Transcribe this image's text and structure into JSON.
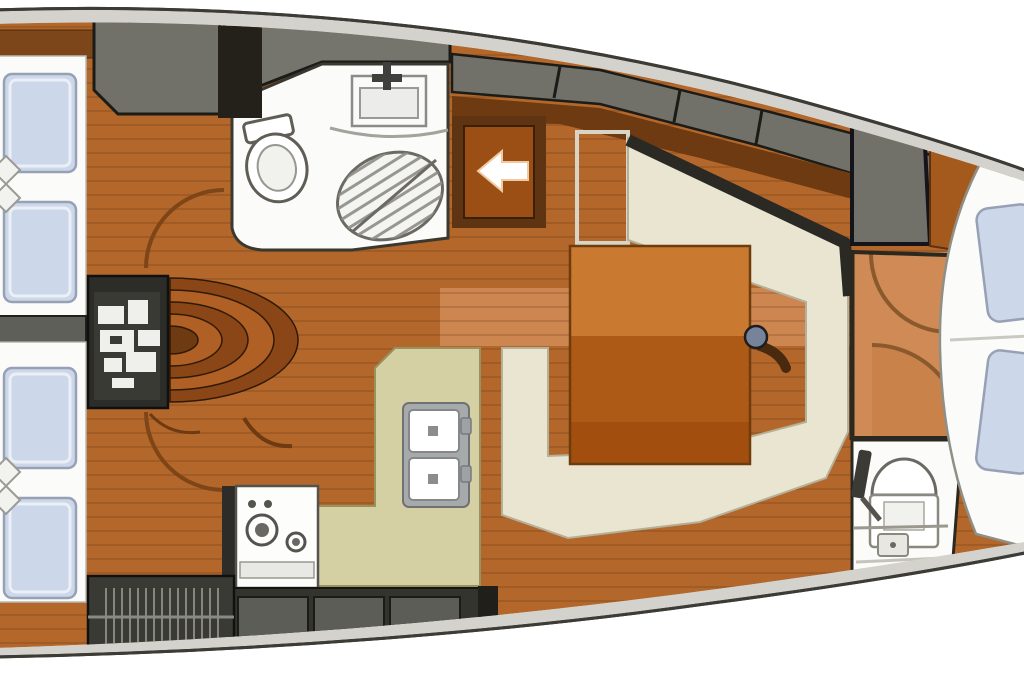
{
  "type": "yacht-interior-floor-plan",
  "visible_text": [],
  "palette": {
    "page_bg": "#ffffff",
    "deck_gray": "#d3d2cd",
    "hull_line": "#3d3b35",
    "wood": "#b4672a",
    "wood_light": "#d08a55",
    "wood_dark": "#6e3a12",
    "trim_brown": "#7c451a",
    "locker_gray": "#71716a",
    "locker_gray2": "#75756e",
    "furniture_dark": "#34342f",
    "door_gray": "#5d5d57",
    "settee_cream": "#e9e5d1",
    "counter_khaki": "#d5cfa4",
    "room_white": "#fbfbf9",
    "cushion_blue": "#ccd7e9",
    "cushion_border": "#97a1b6",
    "table_top": "#c97a30",
    "table_front": "#ad5a16",
    "table_edge": "#a14e0e",
    "steps_light": "#b06024",
    "steps_dark": "#8a4616",
    "arc_brown": "#8a5a2c",
    "entry_panel": "#9c4f14",
    "entry_frame": "#5e3412",
    "arrow_white": "#ffffff",
    "mast_blue": "#76839b",
    "engine_dark": "#2c2c28",
    "hatch_dark": "#3a3a35"
  },
  "features": [
    "hull-outline",
    "side-deck-band",
    "cabin-sole-planks",
    "aft-cabin-upper-berth",
    "aft-cabin-lower-berth",
    "berth-cushions",
    "decorative-diamond-pillows",
    "cabin-divider-wall",
    "cabin-door-swing-arcs",
    "engine-compartment-panel",
    "companionway-steps-fan",
    "head-with-shower",
    "washbasin-with-faucet",
    "toilet",
    "shower-grate-seat",
    "companionway-entry-arrow",
    "deck-lockers",
    "galley-l-counter",
    "double-sink",
    "gimbal-stove",
    "galley-locker-doors",
    "louvered-locker",
    "salon-u-settee",
    "settee-backrest",
    "salon-table",
    "mast-post",
    "open-door-leaf",
    "forward-corridor",
    "forward-door-arcs",
    "hanging-locker",
    "forward-head",
    "forward-toilet",
    "forward-washbasin",
    "forward-v-berth",
    "berth-pillows"
  ]
}
